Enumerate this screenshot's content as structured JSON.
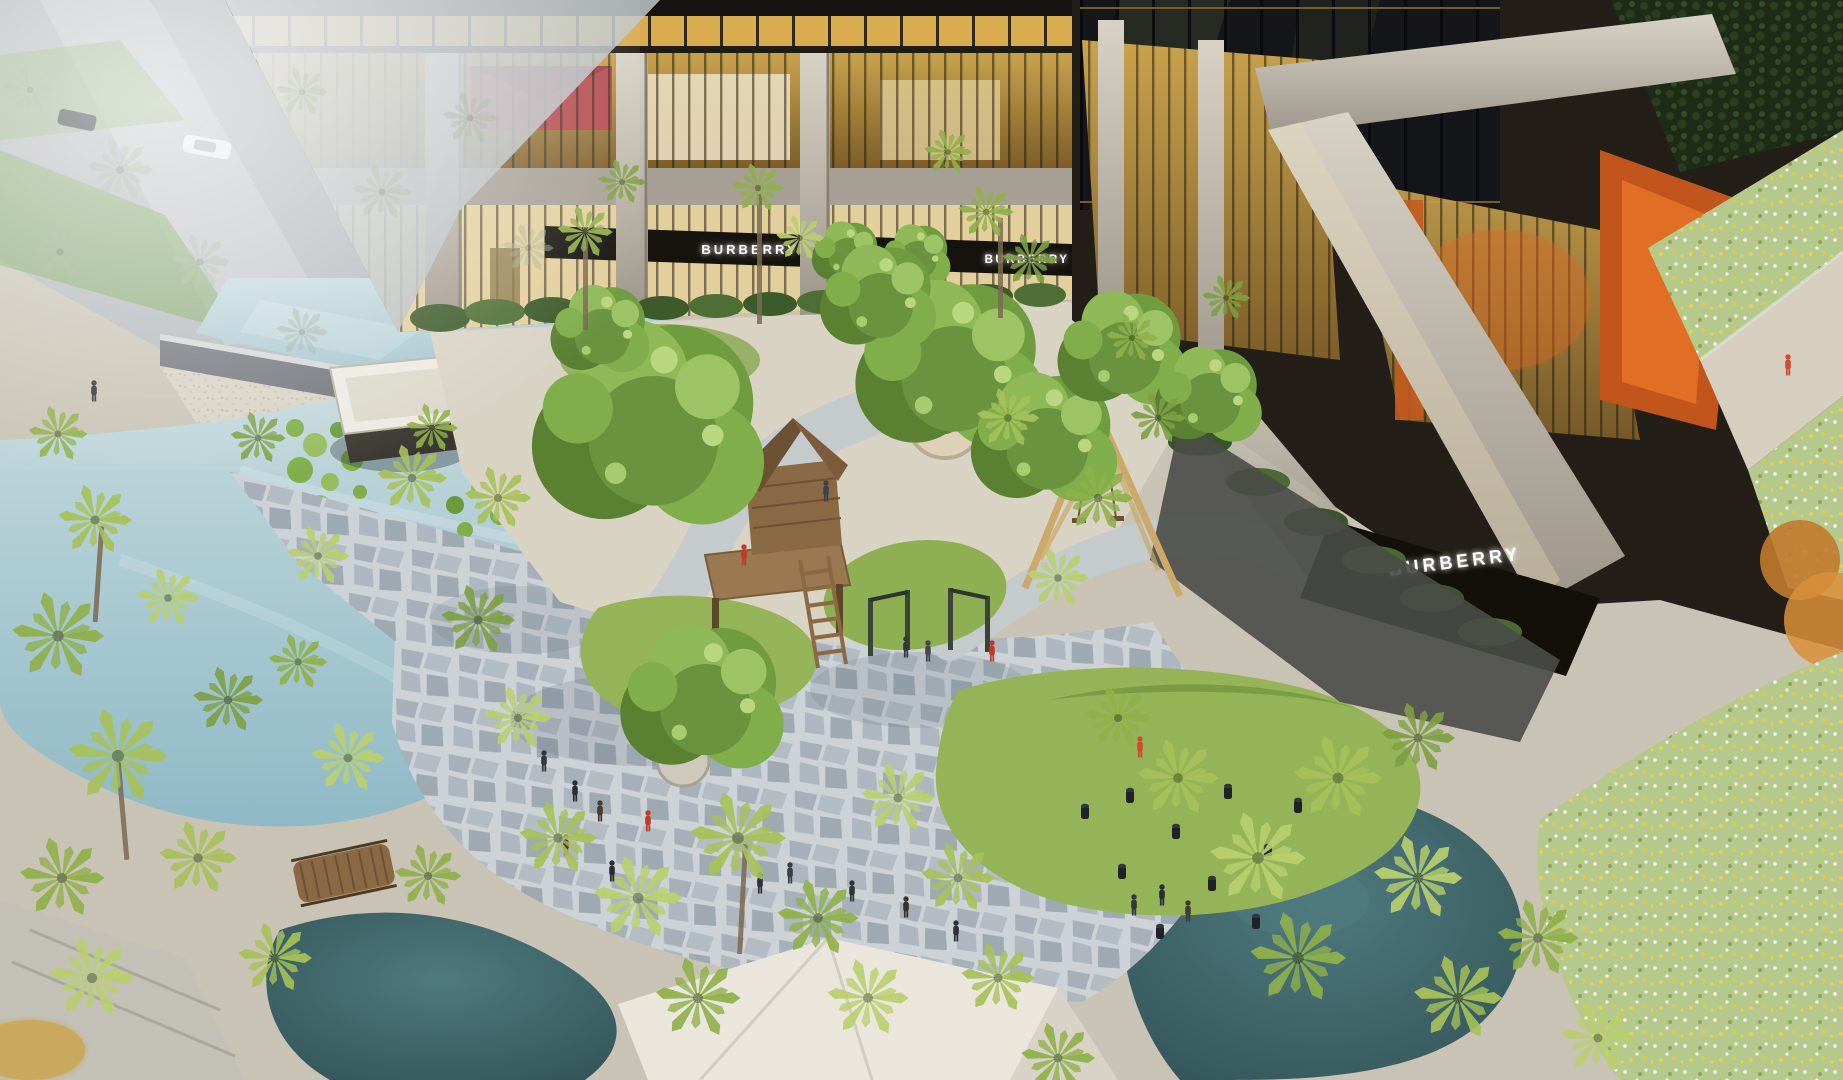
{
  "scene": {
    "type": "aerial-architectural-rendering",
    "signs": {
      "storefront_left": "BURBERRY",
      "storefront_center": "FENDI",
      "storefront_right": "BURBERRY",
      "facade_right": "BURBERRY"
    },
    "colors": {
      "concrete": "#aca69a",
      "glass_warm": "#c39a46",
      "glass_dark": "#15161a",
      "fascia": "#16130e",
      "pool": "#a7c7d0",
      "pond_teal": "#3d6266",
      "grass": "#94b457",
      "palm": "#a6c158",
      "tree_green": "#6f9c3f",
      "flagstone": "#aab3bb",
      "sand": "#d9d2c1",
      "accent_orange": "#c4571f",
      "meadow": "#b7ca8c",
      "sign_light": "#ffffff"
    }
  }
}
